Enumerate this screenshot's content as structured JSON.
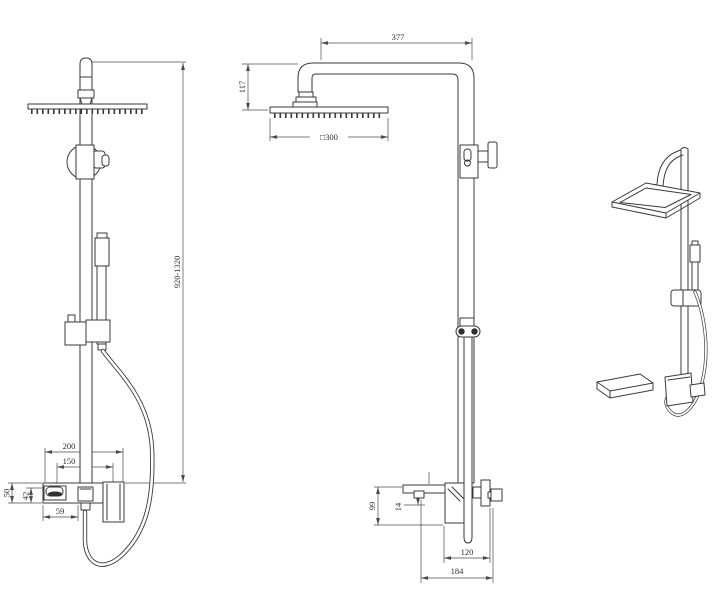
{
  "colors": {
    "background": "#ffffff",
    "line": "#3a3a3a",
    "dimension": "#4b4b4b"
  },
  "dimensions": {
    "height_range": "920-1320",
    "arm_reach": "377",
    "head_drop": "117",
    "head_size": "□300",
    "mixer_width": "200",
    "inlet_centers": "150",
    "mixer_body_height": "50",
    "handle_drop": "42",
    "escutcheon_width": "59",
    "side_mixer_height": "99",
    "spout_lip": "14",
    "spout_reach": "120",
    "overall_depth": "184"
  }
}
